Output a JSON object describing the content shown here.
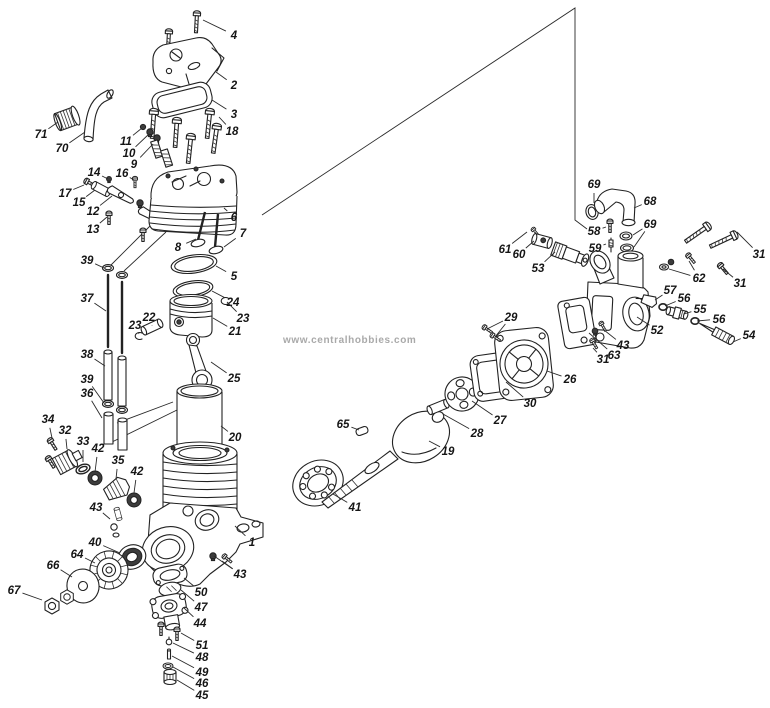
{
  "meta": {
    "watermark": "www.centralhobbies.com",
    "background": "#ffffff",
    "line_color": "#222222",
    "label_color": "#151515",
    "watermark_color": "#a9a9a9"
  },
  "diagram": {
    "type": "exploded-parts-diagram",
    "subject": "model engine exploded view with numbered parts",
    "frame_line": [
      [
        262,
        215
      ],
      [
        575,
        8
      ],
      [
        575,
        220
      ],
      [
        587,
        229
      ]
    ],
    "assembly_lines": [
      [
        [
          111,
          265
        ],
        [
          150,
          226
        ]
      ],
      [
        [
          124,
          271
        ],
        [
          166,
          232
        ]
      ],
      [
        [
          117,
          423
        ],
        [
          173,
          402
        ]
      ],
      [
        [
          112,
          442
        ],
        [
          177,
          410
        ]
      ]
    ],
    "labels": [
      {
        "t": "4",
        "x": 234,
        "y": 35,
        "lx": 203,
        "ly": 20
      },
      {
        "t": "2",
        "x": 234,
        "y": 85,
        "lx": 216,
        "ly": 72
      },
      {
        "t": "3",
        "x": 234,
        "y": 114,
        "lx": 212,
        "ly": 100
      },
      {
        "t": "18",
        "x": 232,
        "y": 131,
        "lx": 219,
        "ly": 117
      },
      {
        "t": "71",
        "x": 41,
        "y": 134,
        "lx": 58,
        "ly": 122
      },
      {
        "t": "70",
        "x": 62,
        "y": 148,
        "lx": 85,
        "ly": 132
      },
      {
        "t": "11",
        "x": 126,
        "y": 141,
        "lx": 142,
        "ly": 128
      },
      {
        "t": "10",
        "x": 129,
        "y": 153,
        "lx": 149,
        "ly": 134
      },
      {
        "t": "9",
        "x": 134,
        "y": 164,
        "lx": 153,
        "ly": 144
      },
      {
        "t": "14",
        "x": 94,
        "y": 172,
        "lx": 108,
        "ly": 179
      },
      {
        "t": "16",
        "x": 122,
        "y": 173,
        "lx": 134,
        "ly": 180
      },
      {
        "t": "17",
        "x": 65,
        "y": 193,
        "lx": 84,
        "ly": 185
      },
      {
        "t": "15",
        "x": 79,
        "y": 202,
        "lx": 95,
        "ly": 190
      },
      {
        "t": "12",
        "x": 93,
        "y": 211,
        "lx": 112,
        "ly": 196
      },
      {
        "t": "13",
        "x": 93,
        "y": 229,
        "lx": 107,
        "ly": 217
      },
      {
        "t": "6",
        "x": 234,
        "y": 217,
        "lx": 224,
        "ly": 208
      },
      {
        "t": "7",
        "x": 243,
        "y": 233,
        "lx": 224,
        "ly": 247
      },
      {
        "t": "8",
        "x": 178,
        "y": 247,
        "lx": 196,
        "ly": 239
      },
      {
        "t": "39",
        "x": 87,
        "y": 260,
        "lx": 104,
        "ly": 268
      },
      {
        "t": "5",
        "x": 234,
        "y": 276,
        "lx": 216,
        "ly": 266
      },
      {
        "t": "37",
        "x": 87,
        "y": 298,
        "lx": 106,
        "ly": 311
      },
      {
        "t": "24",
        "x": 233,
        "y": 302,
        "lx": 212,
        "ly": 291
      },
      {
        "t": "23",
        "x": 243,
        "y": 318,
        "lx": 227,
        "ly": 302
      },
      {
        "t": "22",
        "x": 149,
        "y": 317,
        "lx": 152,
        "ly": 325
      },
      {
        "t": "23",
        "x": 135,
        "y": 325,
        "lx": 139,
        "ly": 334
      },
      {
        "t": "21",
        "x": 235,
        "y": 331,
        "lx": 213,
        "ly": 318
      },
      {
        "t": "38",
        "x": 87,
        "y": 354,
        "lx": 105,
        "ly": 366
      },
      {
        "t": "25",
        "x": 234,
        "y": 378,
        "lx": 211,
        "ly": 362
      },
      {
        "t": "39",
        "x": 87,
        "y": 379,
        "lx": 104,
        "ly": 403
      },
      {
        "t": "36",
        "x": 87,
        "y": 393,
        "lx": 102,
        "ly": 418
      },
      {
        "t": "20",
        "x": 235,
        "y": 437,
        "lx": 221,
        "ly": 426
      },
      {
        "t": "34",
        "x": 48,
        "y": 419,
        "lx": 52,
        "ly": 438
      },
      {
        "t": "32",
        "x": 65,
        "y": 430,
        "lx": 67,
        "ly": 449
      },
      {
        "t": "33",
        "x": 83,
        "y": 441,
        "lx": 83,
        "ly": 462
      },
      {
        "t": "42",
        "x": 98,
        "y": 448,
        "lx": 95,
        "ly": 472
      },
      {
        "t": "35",
        "x": 118,
        "y": 460,
        "lx": 116,
        "ly": 479
      },
      {
        "t": "42",
        "x": 137,
        "y": 471,
        "lx": 134,
        "ly": 493
      },
      {
        "t": "43",
        "x": 96,
        "y": 507,
        "lx": 110,
        "ly": 519
      },
      {
        "t": "40",
        "x": 95,
        "y": 542,
        "lx": 120,
        "ly": 553
      },
      {
        "t": "64",
        "x": 77,
        "y": 554,
        "lx": 95,
        "ly": 563
      },
      {
        "t": "66",
        "x": 53,
        "y": 565,
        "lx": 72,
        "ly": 577
      },
      {
        "t": "67",
        "x": 14,
        "y": 590,
        "lx": 42,
        "ly": 600
      },
      {
        "t": "1",
        "x": 252,
        "y": 542,
        "lx": 235,
        "ly": 526
      },
      {
        "t": "43",
        "x": 240,
        "y": 574,
        "lx": 222,
        "ly": 561,
        "lx2": 214,
        "ly2": 556
      },
      {
        "t": "50",
        "x": 201,
        "y": 592,
        "lx": 184,
        "ly": 578
      },
      {
        "t": "47",
        "x": 201,
        "y": 607,
        "lx": 181,
        "ly": 590
      },
      {
        "t": "44",
        "x": 200,
        "y": 623,
        "lx": 184,
        "ly": 608
      },
      {
        "t": "51",
        "x": 202,
        "y": 645,
        "lx": 181,
        "ly": 633
      },
      {
        "t": "48",
        "x": 202,
        "y": 657,
        "lx": 173,
        "ly": 643
      },
      {
        "t": "49",
        "x": 202,
        "y": 672,
        "lx": 172,
        "ly": 656
      },
      {
        "t": "46",
        "x": 202,
        "y": 683,
        "lx": 173,
        "ly": 667
      },
      {
        "t": "45",
        "x": 202,
        "y": 695,
        "lx": 177,
        "ly": 680
      },
      {
        "t": "65",
        "x": 343,
        "y": 424,
        "lx": 359,
        "ly": 430
      },
      {
        "t": "19",
        "x": 448,
        "y": 451,
        "lx": 429,
        "ly": 441
      },
      {
        "t": "41",
        "x": 355,
        "y": 507,
        "lx": 333,
        "ly": 494
      },
      {
        "t": "28",
        "x": 477,
        "y": 433,
        "lx": 443,
        "ly": 414
      },
      {
        "t": "27",
        "x": 500,
        "y": 420,
        "lx": 472,
        "ly": 401
      },
      {
        "t": "30",
        "x": 530,
        "y": 403,
        "lx": 506,
        "ly": 382
      },
      {
        "t": "26",
        "x": 570,
        "y": 379,
        "lx": 547,
        "ly": 371
      },
      {
        "t": "29",
        "x": 511,
        "y": 317,
        "lx": 487,
        "ly": 329,
        "lx2": 495,
        "ly2": 337
      },
      {
        "t": "69",
        "x": 594,
        "y": 184,
        "lx": 594,
        "ly": 203
      },
      {
        "t": "68",
        "x": 650,
        "y": 201,
        "lx": 634,
        "ly": 208
      },
      {
        "t": "58",
        "x": 594,
        "y": 231,
        "lx": 606,
        "ly": 227
      },
      {
        "t": "69",
        "x": 650,
        "y": 224,
        "lx": 633,
        "ly": 235,
        "lx2": 634,
        "ly2": 247
      },
      {
        "t": "59",
        "x": 595,
        "y": 248,
        "lx": 606,
        "ly": 244
      },
      {
        "t": "61",
        "x": 505,
        "y": 249,
        "lx": 527,
        "ly": 232
      },
      {
        "t": "60",
        "x": 519,
        "y": 254,
        "lx": 534,
        "ly": 241
      },
      {
        "t": "53",
        "x": 538,
        "y": 268,
        "lx": 555,
        "ly": 252
      },
      {
        "t": "62",
        "x": 699,
        "y": 278,
        "lx": 689,
        "ly": 261,
        "lx2": 669,
        "ly2": 269
      },
      {
        "t": "31",
        "x": 759,
        "y": 254,
        "lx": 737,
        "ly": 232
      },
      {
        "t": "31",
        "x": 740,
        "y": 283,
        "lx": 723,
        "ly": 269
      },
      {
        "t": "57",
        "x": 670,
        "y": 290,
        "lx": 655,
        "ly": 300
      },
      {
        "t": "56",
        "x": 684,
        "y": 298,
        "lx": 665,
        "ly": 306
      },
      {
        "t": "55",
        "x": 700,
        "y": 309,
        "lx": 684,
        "ly": 314
      },
      {
        "t": "56",
        "x": 719,
        "y": 319,
        "lx": 697,
        "ly": 321
      },
      {
        "t": "54",
        "x": 749,
        "y": 335,
        "lx": 733,
        "ly": 342
      },
      {
        "t": "52",
        "x": 657,
        "y": 330,
        "lx": 637,
        "ly": 317
      },
      {
        "t": "43",
        "x": 623,
        "y": 345,
        "lx": 604,
        "ly": 330
      },
      {
        "t": "63",
        "x": 614,
        "y": 355,
        "lx": 589,
        "ly": 333
      },
      {
        "t": "31",
        "x": 603,
        "y": 359,
        "lx": 593,
        "ly": 348
      }
    ]
  }
}
